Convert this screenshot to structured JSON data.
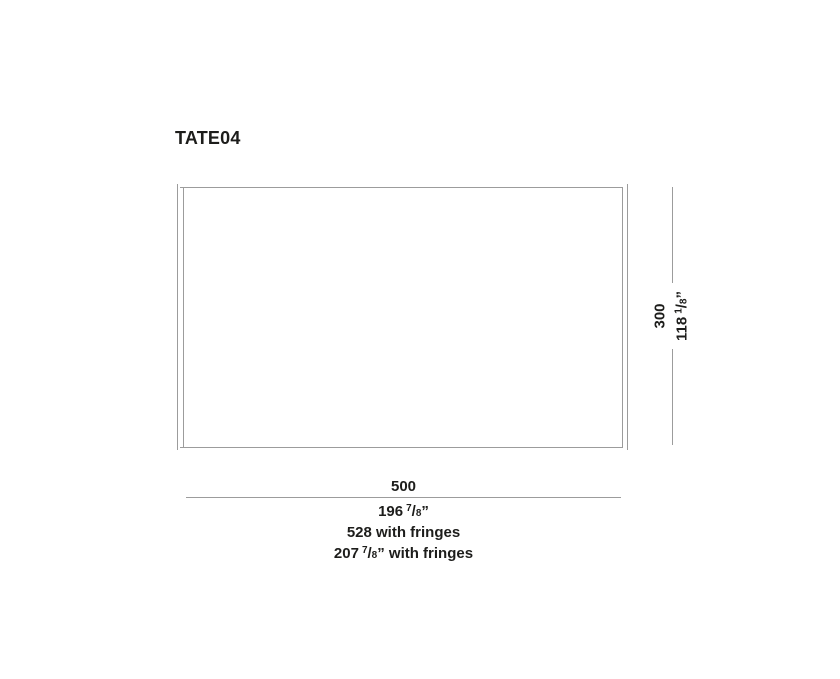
{
  "title": "TATE04",
  "colors": {
    "line": "#9c9c9c",
    "text": "#1d1d1b",
    "background": "#ffffff"
  },
  "height_label": {
    "metric": "300",
    "imperial": {
      "whole": "118",
      "num": "1",
      "slash": "/",
      "den": "8",
      "tail": "”"
    }
  },
  "width_label": {
    "metric": "500",
    "imperial": {
      "whole": "196",
      "num": "7",
      "slash": "/",
      "den": "8",
      "tail": "”"
    }
  },
  "fringe_label": {
    "metric": "528 with fringes",
    "imperial": {
      "whole": "207",
      "num": "7",
      "slash": "/",
      "den": "8",
      "tail": "” with fringes"
    }
  }
}
